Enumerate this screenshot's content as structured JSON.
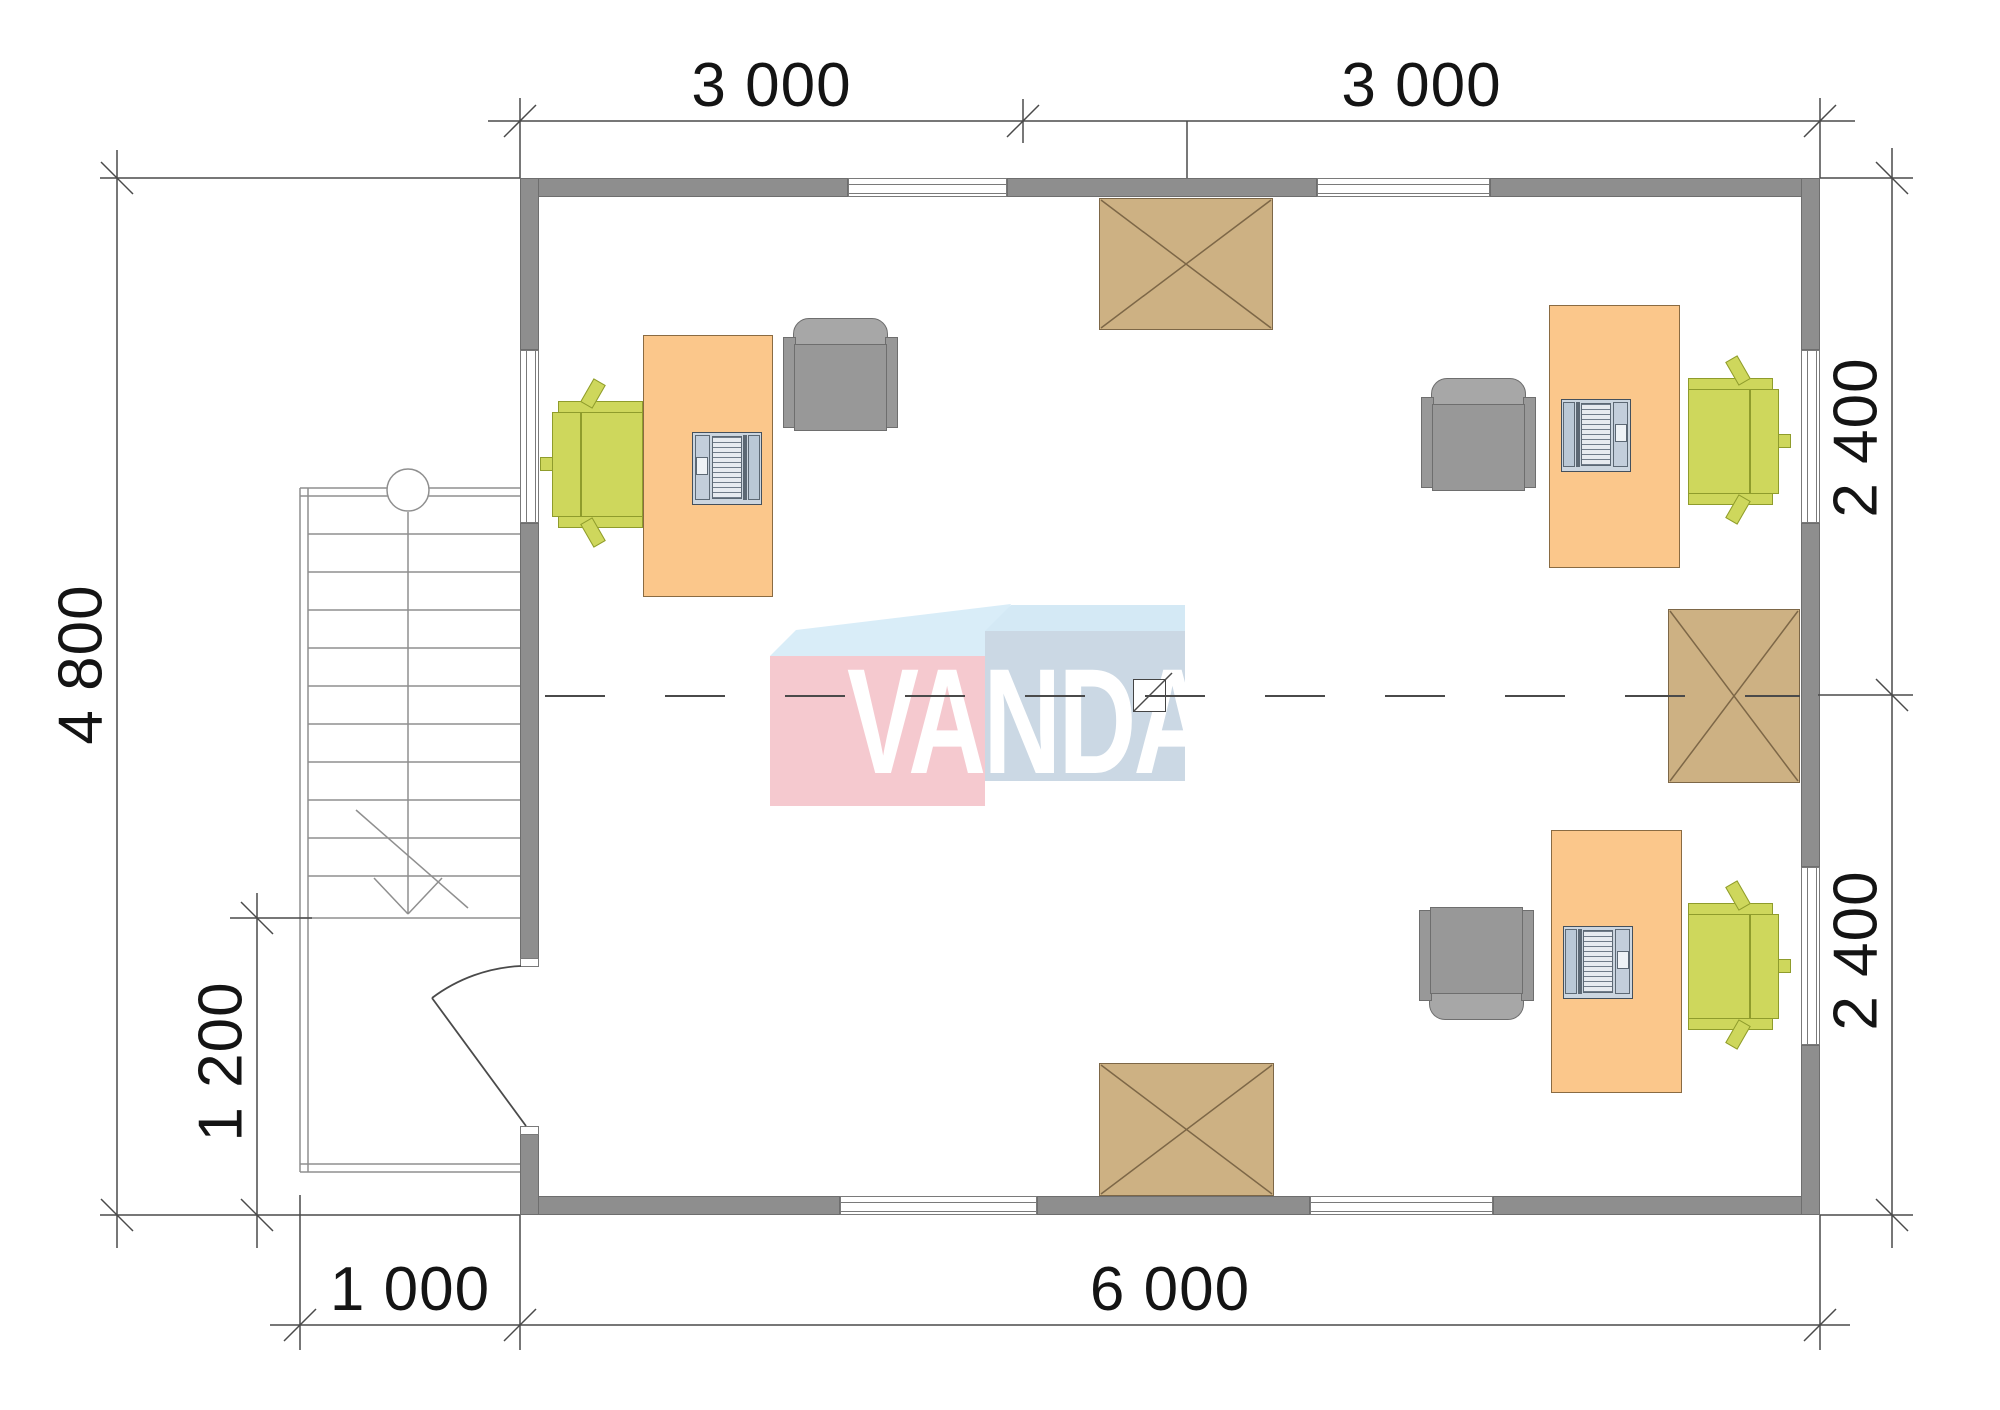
{
  "logo": {
    "text": "VANDA"
  },
  "dimensions": {
    "top": [
      {
        "label": "3 000"
      },
      {
        "label": "3 000"
      }
    ],
    "right": [
      {
        "label": "2 400"
      },
      {
        "label": "2 400"
      }
    ],
    "left": {
      "label": "4 800"
    },
    "annex": {
      "label": "1 200"
    },
    "bottom": [
      {
        "label": "1 000"
      },
      {
        "label": "6 000"
      }
    ]
  },
  "colors": {
    "wall": "#8e8e8e",
    "wall-edge": "#6e6e6e",
    "line": "#4a4a4a",
    "thin": "#8f8f8f",
    "text": "#141414",
    "desk": "#fbc78b",
    "desk-edge": "#8a6b42",
    "chair": "#ced75c",
    "chair-edge": "#8f9c2c",
    "armchair": "#989898",
    "armchair-back": "#a7a7a7",
    "armchair-edge": "#6e6e6e",
    "table": "#cdb183",
    "table-edge": "#7d6747",
    "laptop": "#ccd6e0",
    "laptop-edge": "#44505c",
    "logo-pink": "#f5c9cf",
    "logo-blue": "#cbd8e4",
    "logo-top": "#d9edf8",
    "logo-top2": "#d4e9f5"
  }
}
